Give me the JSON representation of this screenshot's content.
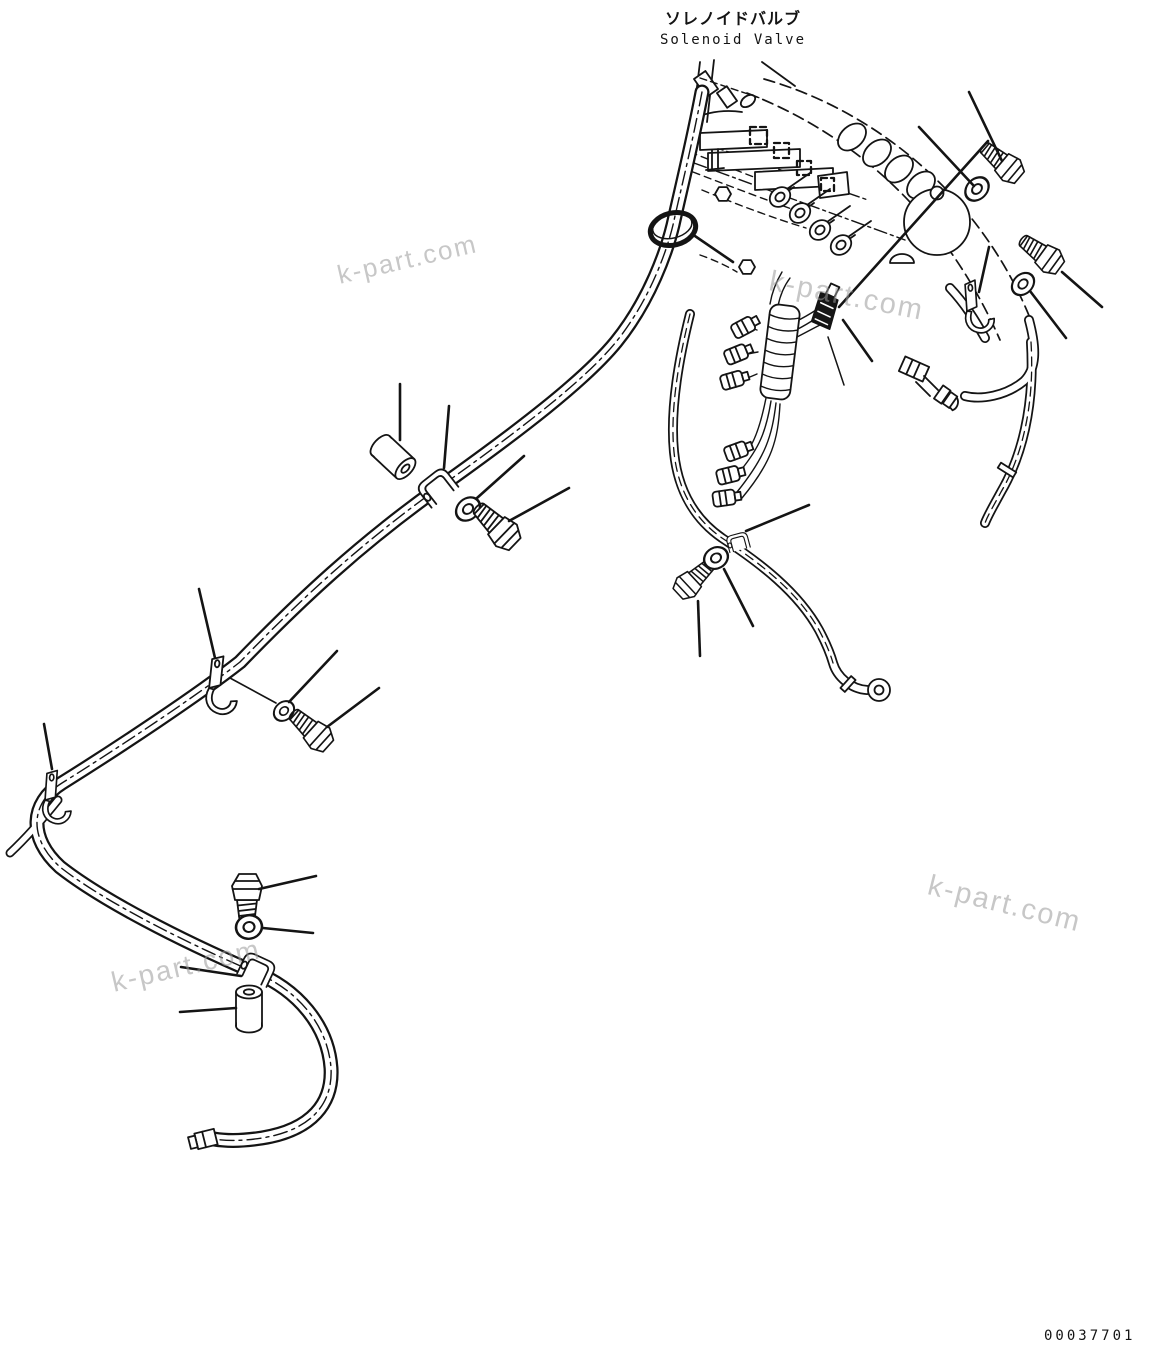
{
  "page": {
    "background_color": "#ffffff",
    "line_color": "#141414",
    "watermark_color": "#9b9b9b"
  },
  "header": {
    "title_jp": "ソレノイドバルブ",
    "title_en": "Solenoid Valve"
  },
  "watermark": {
    "text": "k-part.com"
  },
  "footer": {
    "drawing_number": "00037701"
  },
  "diagram": {
    "description": "Parts-catalog line drawing: solenoid valve assembly with hydraulic hoses, wiring harness and mounting hardware callouts",
    "callouts": [
      {
        "name": "hose-band-clip-upper",
        "part": "band clip on upper hose bundle"
      },
      {
        "name": "spacer-roller-mid-left",
        "part": "cylindrical spacer"
      },
      {
        "name": "hose-clamp-mid-left",
        "part": "hose clamp"
      },
      {
        "name": "washer-mid-left",
        "part": "washer"
      },
      {
        "name": "bolt-mid-left",
        "part": "hex bolt"
      },
      {
        "name": "hose-clamp-left",
        "part": "hose clamp bracket"
      },
      {
        "name": "washer-left",
        "part": "washer"
      },
      {
        "name": "bolt-left",
        "part": "hex bolt"
      },
      {
        "name": "hose-clamp-lower-left",
        "part": "hose clamp bracket"
      },
      {
        "name": "bolt-bottom-left",
        "part": "hex bolt"
      },
      {
        "name": "washer-bottom-left",
        "part": "washer"
      },
      {
        "name": "hose-clamp-bottom-left",
        "part": "hose clamp"
      },
      {
        "name": "bushing-bottom-left",
        "part": "cylindrical bushing"
      },
      {
        "name": "washer-top-right",
        "part": "washer"
      },
      {
        "name": "bolt-top-right",
        "part": "hex bolt"
      },
      {
        "name": "harness-clamp-center",
        "part": "wiring harness clamp"
      },
      {
        "name": "hose-clamp-right",
        "part": "hose clamp bracket"
      },
      {
        "name": "washer-right",
        "part": "washer"
      },
      {
        "name": "bolt-right",
        "part": "hex bolt"
      },
      {
        "name": "bolt-bottom-center",
        "part": "hex bolt"
      },
      {
        "name": "washer-bottom-center",
        "part": "washer"
      },
      {
        "name": "hose-clip-bottom-center",
        "part": "hose clip"
      }
    ]
  }
}
